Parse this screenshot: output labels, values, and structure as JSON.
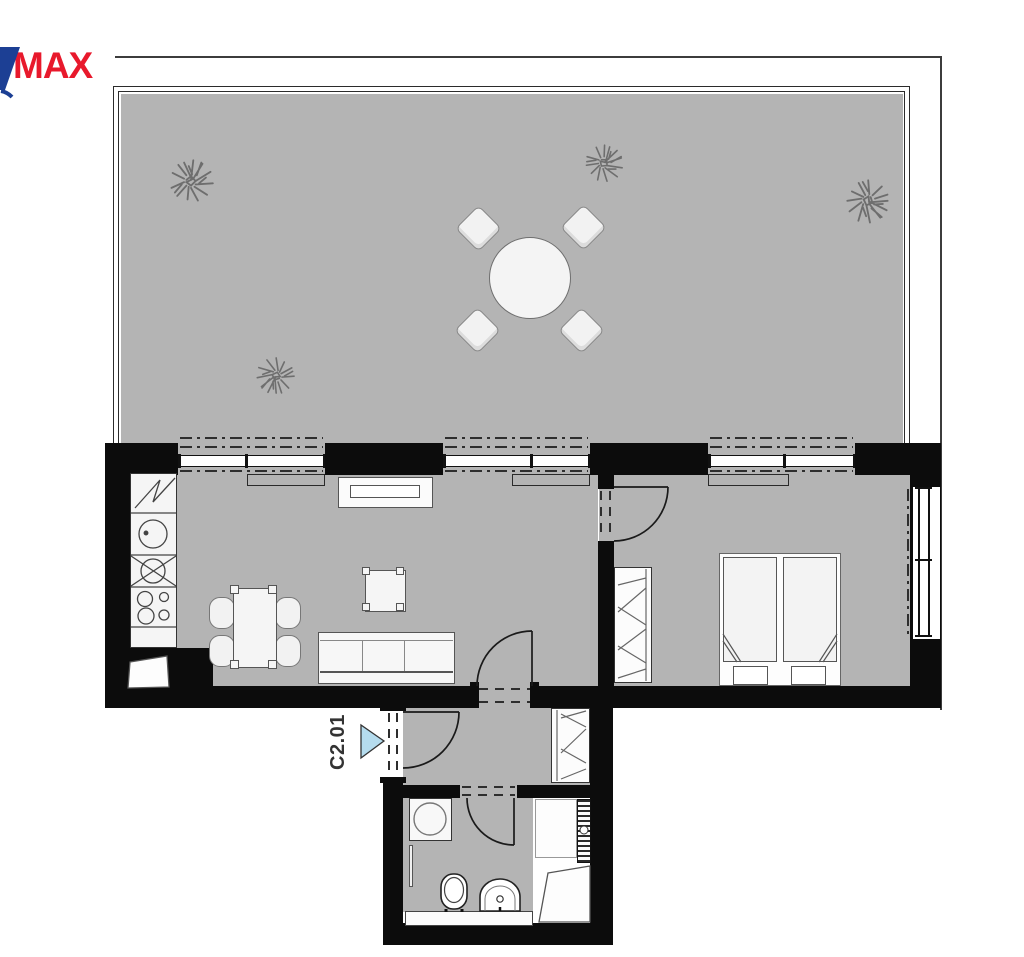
{
  "page": {
    "type": "apartment-floor-plan"
  },
  "logo": {
    "text": "MAX",
    "red": "#e8192c",
    "blue": "#1c3f94"
  },
  "unit": {
    "label": "C2.01",
    "marker_color": "#b5dcee"
  },
  "palette": {
    "background": "#ffffff",
    "floor_gray": "#b4b4b4",
    "wall_black": "#0c0c0c",
    "fixture_fill": "#f5f5f5",
    "line": "#333333",
    "frame_line": "#3c3c3c",
    "tree_stroke": "#6e6e6e"
  },
  "icons": [
    "terrace-tree-icon",
    "round-table-icon",
    "terrace-chair-icon",
    "fridge-icon",
    "kitchen-sink-icon",
    "hob-icon",
    "burner-icon",
    "dining-table-icon",
    "dining-chair-icon",
    "coffee-table-icon",
    "sofa-icon",
    "radiator-icon",
    "double-bed-icon",
    "pillow-icon",
    "wardrobe-icon",
    "washing-machine-icon",
    "toilet-icon",
    "bathroom-sink-icon",
    "towel-radiator-icon",
    "shower-tray-icon",
    "entrance-arrow-icon",
    "door-swing-icon",
    "window-icon"
  ]
}
